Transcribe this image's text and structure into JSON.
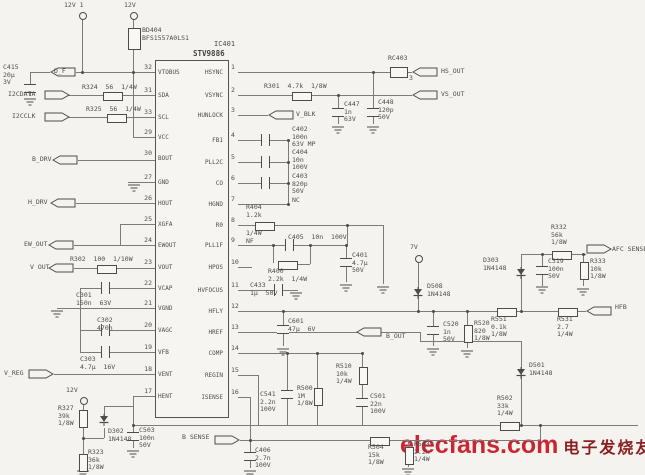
{
  "colors": {
    "background": "#f4f3f0",
    "ink": "#4c4c4c",
    "wire": "#7b7b78",
    "watermark_red": "#cc2430",
    "watermark_dark": "#8a2020"
  },
  "watermark": {
    "latin": "elecfans.com",
    "cjk": "电子发烧友"
  },
  "ic": {
    "ref": "IC401",
    "part": "STV9886",
    "left_pins": [
      {
        "n": "32",
        "name": "VTOBUS",
        "y": 72
      },
      {
        "n": "31",
        "name": "SDA",
        "y": 95
      },
      {
        "n": "33",
        "name": "SCL",
        "y": 117
      },
      {
        "n": "29",
        "name": "VCC",
        "y": 137
      },
      {
        "n": "30",
        "name": "BOUT",
        "y": 158
      },
      {
        "n": "27",
        "name": "GND",
        "y": 182
      },
      {
        "n": "26",
        "name": "HOUT",
        "y": 203
      },
      {
        "n": "25",
        "name": "XGFA",
        "y": 224
      },
      {
        "n": "24",
        "name": "EWOUT",
        "y": 245
      },
      {
        "n": "23",
        "name": "VOUT",
        "y": 267
      },
      {
        "n": "22",
        "name": "VCAP",
        "y": 288
      },
      {
        "n": "21",
        "name": "VGND",
        "y": 308
      },
      {
        "n": "20",
        "name": "VAGC",
        "y": 330
      },
      {
        "n": "19",
        "name": "VFB",
        "y": 352
      },
      {
        "n": "18",
        "name": "VENT",
        "y": 374
      },
      {
        "n": "17",
        "name": "HENT",
        "y": 396
      }
    ],
    "right_pins": [
      {
        "n": "1",
        "name": "HSYNC",
        "y": 72
      },
      {
        "n": "2",
        "name": "VSYNC",
        "y": 95
      },
      {
        "n": "3",
        "name": "HUNLOCK",
        "y": 115
      },
      {
        "n": "4",
        "name": "FB1",
        "y": 140
      },
      {
        "n": "5",
        "name": "PLL2C",
        "y": 162
      },
      {
        "n": "6",
        "name": "CO",
        "y": 183
      },
      {
        "n": "7",
        "name": "HGND",
        "y": 204
      },
      {
        "n": "8",
        "name": "R0",
        "y": 225
      },
      {
        "n": "9",
        "name": "PLL1F",
        "y": 245
      },
      {
        "n": "10",
        "name": "HPOS",
        "y": 267
      },
      {
        "n": "11",
        "name": "HVFOCUS",
        "y": 290
      },
      {
        "n": "12",
        "name": "HFLY",
        "y": 311
      },
      {
        "n": "13",
        "name": "HREF",
        "y": 332
      },
      {
        "n": "14",
        "name": "COMP",
        "y": 353
      },
      {
        "n": "15",
        "name": "REGIN",
        "y": 375
      },
      {
        "n": "16",
        "name": "ISENSE",
        "y": 397
      }
    ]
  },
  "schematic": {
    "wires": [
      [
        30,
        72,
        20,
        "h"
      ],
      [
        76,
        72,
        79,
        "h"
      ],
      [
        64,
        95,
        39,
        "h"
      ],
      [
        121,
        95,
        34,
        "h"
      ],
      [
        64,
        117,
        43,
        "h"
      ],
      [
        125,
        117,
        30,
        "h"
      ],
      [
        133,
        137,
        22,
        "h"
      ],
      [
        78,
        160,
        77,
        "h"
      ],
      [
        128,
        182,
        27,
        "h"
      ],
      [
        76,
        203,
        79,
        "h"
      ],
      [
        120,
        224,
        35,
        "h"
      ],
      [
        120,
        224,
        21,
        "v"
      ],
      [
        74,
        245,
        81,
        "h"
      ],
      [
        74,
        268,
        23,
        "h"
      ],
      [
        115,
        268,
        40,
        "h"
      ],
      [
        80,
        288,
        21,
        "h"
      ],
      [
        108,
        288,
        47,
        "h"
      ],
      [
        57,
        308,
        98,
        "h"
      ],
      [
        80,
        330,
        21,
        "h"
      ],
      [
        108,
        330,
        47,
        "h"
      ],
      [
        80,
        352,
        21,
        "h"
      ],
      [
        108,
        352,
        47,
        "h"
      ],
      [
        54,
        374,
        101,
        "h"
      ],
      [
        133,
        396,
        22,
        "h"
      ],
      [
        80,
        288,
        64,
        "v"
      ],
      [
        82,
        18,
        54,
        "v"
      ],
      [
        133,
        18,
        10,
        "v"
      ],
      [
        133,
        48,
        89,
        "v"
      ],
      [
        30,
        72,
        12,
        "v"
      ],
      [
        30,
        91,
        5,
        "v"
      ],
      [
        83,
        403,
        7,
        "v"
      ],
      [
        83,
        426,
        28,
        "v"
      ],
      [
        83,
        438,
        21,
        "h"
      ],
      [
        104,
        406,
        10,
        "v"
      ],
      [
        104,
        428,
        10,
        "v"
      ],
      [
        104,
        406,
        29,
        "h"
      ],
      [
        133,
        396,
        29,
        "v"
      ],
      [
        133,
        425,
        7,
        "v"
      ],
      [
        133,
        439,
        9,
        "v"
      ],
      [
        238,
        72,
        152,
        "h"
      ],
      [
        406,
        72,
        6,
        "h"
      ],
      [
        238,
        95,
        54,
        "h"
      ],
      [
        310,
        95,
        102,
        "h"
      ],
      [
        238,
        115,
        30,
        "h"
      ],
      [
        238,
        140,
        23,
        "h"
      ],
      [
        268,
        140,
        20,
        "h"
      ],
      [
        238,
        162,
        23,
        "h"
      ],
      [
        268,
        162,
        20,
        "h"
      ],
      [
        238,
        183,
        23,
        "h"
      ],
      [
        268,
        183,
        20,
        "h"
      ],
      [
        238,
        204,
        50,
        "h"
      ],
      [
        288,
        140,
        64,
        "v"
      ],
      [
        238,
        225,
        17,
        "h"
      ],
      [
        273,
        225,
        110,
        "h"
      ],
      [
        347,
        225,
        20,
        "v"
      ],
      [
        383,
        225,
        59,
        "v"
      ],
      [
        238,
        245,
        47,
        "h"
      ],
      [
        292,
        245,
        55,
        "h"
      ],
      [
        273,
        245,
        18,
        "v"
      ],
      [
        294,
        264,
        16,
        "h"
      ],
      [
        310,
        245,
        19,
        "v"
      ],
      [
        346,
        245,
        13,
        "v"
      ],
      [
        346,
        265,
        17,
        "v"
      ],
      [
        238,
        267,
        14,
        "h"
      ],
      [
        238,
        290,
        36,
        "h"
      ],
      [
        281,
        290,
        17,
        "h"
      ],
      [
        238,
        311,
        259,
        "h"
      ],
      [
        515,
        311,
        43,
        "h"
      ],
      [
        576,
        311,
        10,
        "h"
      ],
      [
        418,
        261,
        50,
        "v"
      ],
      [
        433,
        311,
        15,
        "v"
      ],
      [
        433,
        333,
        13,
        "v"
      ],
      [
        467,
        311,
        14,
        "v"
      ],
      [
        467,
        341,
        7,
        "v"
      ],
      [
        521,
        254,
        57,
        "v"
      ],
      [
        521,
        254,
        31,
        "h"
      ],
      [
        570,
        254,
        16,
        "h"
      ],
      [
        542,
        254,
        12,
        "v"
      ],
      [
        542,
        273,
        13,
        "v"
      ],
      [
        583,
        254,
        8,
        "v"
      ],
      [
        583,
        278,
        8,
        "v"
      ],
      [
        238,
        332,
        182,
        "h"
      ],
      [
        420,
        332,
        9,
        "v"
      ],
      [
        420,
        341,
        101,
        "h"
      ],
      [
        521,
        341,
        84,
        "v"
      ],
      [
        238,
        353,
        124,
        "h"
      ],
      [
        287,
        353,
        37,
        "v"
      ],
      [
        287,
        397,
        28,
        "v"
      ],
      [
        317,
        353,
        35,
        "v"
      ],
      [
        317,
        404,
        21,
        "v"
      ],
      [
        362,
        353,
        14,
        "v"
      ],
      [
        362,
        383,
        15,
        "v"
      ],
      [
        362,
        405,
        20,
        "v"
      ],
      [
        238,
        375,
        20,
        "h"
      ],
      [
        258,
        375,
        50,
        "v"
      ],
      [
        238,
        397,
        12,
        "h"
      ],
      [
        250,
        397,
        43,
        "v"
      ],
      [
        133,
        425,
        367,
        "h"
      ],
      [
        517,
        425,
        121,
        "h"
      ],
      [
        250,
        440,
        120,
        "h"
      ],
      [
        388,
        440,
        152,
        "h"
      ],
      [
        540,
        425,
        15,
        "v"
      ],
      [
        408,
        440,
        7,
        "v"
      ],
      [
        408,
        463,
        4,
        "v"
      ],
      [
        250,
        440,
        12,
        "v"
      ],
      [
        250,
        459,
        9,
        "v"
      ],
      [
        240,
        440,
        10,
        "h"
      ],
      [
        338,
        95,
        13,
        "v"
      ],
      [
        338,
        115,
        9,
        "v"
      ],
      [
        373,
        72,
        36,
        "v"
      ],
      [
        373,
        115,
        9,
        "v"
      ],
      [
        283,
        311,
        14,
        "v"
      ],
      [
        283,
        333,
        13,
        "v"
      ]
    ],
    "dots": [
      [
        82,
        72
      ],
      [
        133,
        72
      ],
      [
        373,
        72
      ],
      [
        338,
        95
      ],
      [
        288,
        140
      ],
      [
        288,
        162
      ],
      [
        288,
        183
      ],
      [
        288,
        204
      ],
      [
        273,
        245
      ],
      [
        310,
        245
      ],
      [
        346,
        245
      ],
      [
        347,
        225
      ],
      [
        418,
        311
      ],
      [
        433,
        311
      ],
      [
        467,
        311
      ],
      [
        521,
        311
      ],
      [
        283,
        311
      ],
      [
        542,
        254
      ],
      [
        583,
        254
      ],
      [
        287,
        353
      ],
      [
        317,
        353
      ],
      [
        362,
        353
      ],
      [
        250,
        440
      ],
      [
        133,
        425
      ],
      [
        521,
        425
      ],
      [
        540,
        425
      ],
      [
        83,
        438
      ]
    ],
    "terminals": [
      [
        79,
        12
      ],
      [
        130,
        12
      ],
      [
        80,
        397
      ],
      [
        415,
        255
      ]
    ],
    "grounds": [
      [
        24,
        98
      ],
      [
        128,
        184
      ],
      [
        332,
        126
      ],
      [
        367,
        126
      ],
      [
        51,
        310
      ],
      [
        340,
        284
      ],
      [
        377,
        286
      ],
      [
        290,
        292
      ],
      [
        536,
        286
      ],
      [
        577,
        288
      ],
      [
        427,
        348
      ],
      [
        461,
        350
      ],
      [
        127,
        450
      ],
      [
        244,
        470
      ],
      [
        402,
        468
      ],
      [
        77,
        470
      ],
      [
        277,
        348
      ]
    ],
    "flags": [
      [
        "L",
        50,
        67
      ],
      [
        "L",
        52,
        155
      ],
      [
        "L",
        50,
        198
      ],
      [
        "L",
        48,
        240
      ],
      [
        "L",
        48,
        263
      ],
      [
        "L",
        412,
        67
      ],
      [
        "L",
        412,
        90
      ],
      [
        "L",
        356,
        327
      ],
      [
        "L",
        586,
        306
      ],
      [
        "L",
        268,
        110
      ],
      [
        "R",
        44,
        90
      ],
      [
        "R",
        44,
        112
      ],
      [
        "R",
        28,
        369
      ],
      [
        "R",
        214,
        435
      ],
      [
        "R",
        586,
        244
      ]
    ],
    "components": [
      [
        "box",
        128,
        28,
        11,
        20
      ],
      [
        "box",
        390,
        67,
        16,
        9
      ],
      [
        "rh",
        103,
        92
      ],
      [
        "rh",
        107,
        114
      ],
      [
        "rh",
        97,
        265
      ],
      [
        "rh",
        292,
        92
      ],
      [
        "rh",
        255,
        222
      ],
      [
        "rh",
        278,
        261
      ],
      [
        "rh",
        497,
        308
      ],
      [
        "rh",
        558,
        308
      ],
      [
        "rh",
        552,
        251
      ],
      [
        "rh",
        370,
        437
      ],
      [
        "rh",
        500,
        422
      ],
      [
        "rv",
        79,
        410
      ],
      [
        "rv",
        79,
        454
      ],
      [
        "rv",
        314,
        388
      ],
      [
        "rv",
        359,
        367
      ],
      [
        "rv",
        464,
        325
      ],
      [
        "rv",
        580,
        262
      ],
      [
        "rv",
        405,
        447
      ],
      [
        "ch",
        101,
        282
      ],
      [
        "ch",
        101,
        324
      ],
      [
        "ch",
        101,
        346
      ],
      [
        "ch",
        261,
        134
      ],
      [
        "ch",
        261,
        156
      ],
      [
        "ch",
        261,
        177
      ],
      [
        "ch",
        285,
        239
      ],
      [
        "ch",
        274,
        284
      ],
      [
        "cv",
        24,
        84
      ],
      [
        "cv",
        332,
        108
      ],
      [
        "cv",
        367,
        108
      ],
      [
        "cv",
        340,
        258
      ],
      [
        "cv",
        277,
        325
      ],
      [
        "cv",
        427,
        326
      ],
      [
        "cv",
        536,
        266
      ],
      [
        "cv",
        281,
        390
      ],
      [
        "cv",
        356,
        398
      ],
      [
        "cv",
        127,
        432
      ],
      [
        "cv",
        244,
        452
      ],
      [
        "dd",
        98,
        414
      ],
      [
        "dd",
        515,
        267
      ],
      [
        "dd",
        412,
        287
      ],
      [
        "dd",
        515,
        367
      ]
    ],
    "labels": [
      [
        "12V 1",
        64,
        2
      ],
      [
        "12V",
        124,
        2
      ],
      [
        "BD404\nBFS1557A0LS1",
        142,
        27
      ],
      [
        "C415\n20µ\n3V",
        3,
        64
      ],
      [
        "D_F",
        54,
        68
      ],
      [
        "I2CDATA",
        8,
        91
      ],
      [
        "R324  56  1/4W",
        82,
        84
      ],
      [
        "I2CCLK",
        12,
        113
      ],
      [
        "R325  56  1/4W",
        86,
        106
      ],
      [
        "B_DRV",
        32,
        156
      ],
      [
        "H_DRV",
        28,
        199
      ],
      [
        "EW_OUT",
        24,
        241
      ],
      [
        "R302  100  1/10W",
        70,
        256
      ],
      [
        "V OUT",
        30,
        264
      ],
      [
        "C301\n150n  63V",
        76,
        292
      ],
      [
        "C302\n470n",
        97,
        317
      ],
      [
        "C303\n4.7µ  16V",
        80,
        356
      ],
      [
        "V_REG",
        4,
        370
      ],
      [
        "12V",
        66,
        387
      ],
      [
        "R327\n39k\n1/8W",
        58,
        405
      ],
      [
        "D302\n1N4148",
        108,
        428
      ],
      [
        "R323\n36k\n1/8W",
        88,
        449
      ],
      [
        "C503\n100n\n50V",
        139,
        427
      ],
      [
        "B SENSE",
        182,
        434
      ],
      [
        "C406\n2.7n\n100V",
        255,
        447
      ],
      [
        "R301  4.7k  1/8W",
        264,
        83
      ],
      [
        "RC403",
        388,
        55
      ],
      [
        "3",
        409,
        75
      ],
      [
        "HS_OUT",
        441,
        68
      ],
      [
        "VS_OUT",
        441,
        91
      ],
      [
        "C447\n1n\n63V",
        344,
        101
      ],
      [
        "C448\n120p\n50V",
        378,
        99
      ],
      [
        "V_BLK",
        296,
        111
      ],
      [
        "C402\n100n\n63V MP",
        292,
        126
      ],
      [
        "C404\n10n\n100V",
        292,
        149
      ],
      [
        "C403\n820p\n50V",
        292,
        173
      ],
      [
        "NC",
        292,
        197
      ],
      [
        "R404\n1.2k",
        246,
        204
      ],
      [
        "1/4W\nNF",
        246,
        230
      ],
      [
        "C405  10n  100V",
        288,
        234
      ],
      [
        "R400\n2.2k  1/4W",
        268,
        268
      ],
      [
        "C401\n4.7µ\n50V",
        352,
        252
      ],
      [
        "C433\n1µ  50V",
        250,
        282
      ],
      [
        "C601\n47µ  6V",
        288,
        318
      ],
      [
        "7V",
        410,
        244
      ],
      [
        "D508\n1N4148",
        427,
        283
      ],
      [
        "C520\n1n\n50V",
        443,
        321
      ],
      [
        "R520\n820\n1/8W",
        474,
        320
      ],
      [
        "R551\n0.1k\n1/8W",
        491,
        316
      ],
      [
        "R531\n2.7\n1/4W",
        557,
        316
      ],
      [
        "HFB",
        615,
        304
      ],
      [
        "D303\n1N4148",
        483,
        257
      ],
      [
        "C319\n100n\n50V",
        548,
        258
      ],
      [
        "R332\n56k\n1/8W",
        551,
        224
      ],
      [
        "R333\n10k\n1/8W",
        590,
        258
      ],
      [
        "AFC SENSE",
        612,
        246
      ],
      [
        "B_OUT",
        386,
        333
      ],
      [
        "C541\n2.2n\n100V",
        260,
        391
      ],
      [
        "R500\n1M\n1/8W",
        297,
        385
      ],
      [
        "R510\n10k\n1/4W",
        336,
        363
      ],
      [
        "C501\n22n\n100V",
        370,
        393
      ],
      [
        "R504\n15k\n1/8W",
        368,
        444
      ],
      [
        "R503\n2.2k\n1/4W",
        414,
        441
      ],
      [
        "R502\n33k\n1/4W",
        497,
        395
      ],
      [
        "D501\n1N4148",
        529,
        362
      ]
    ]
  }
}
